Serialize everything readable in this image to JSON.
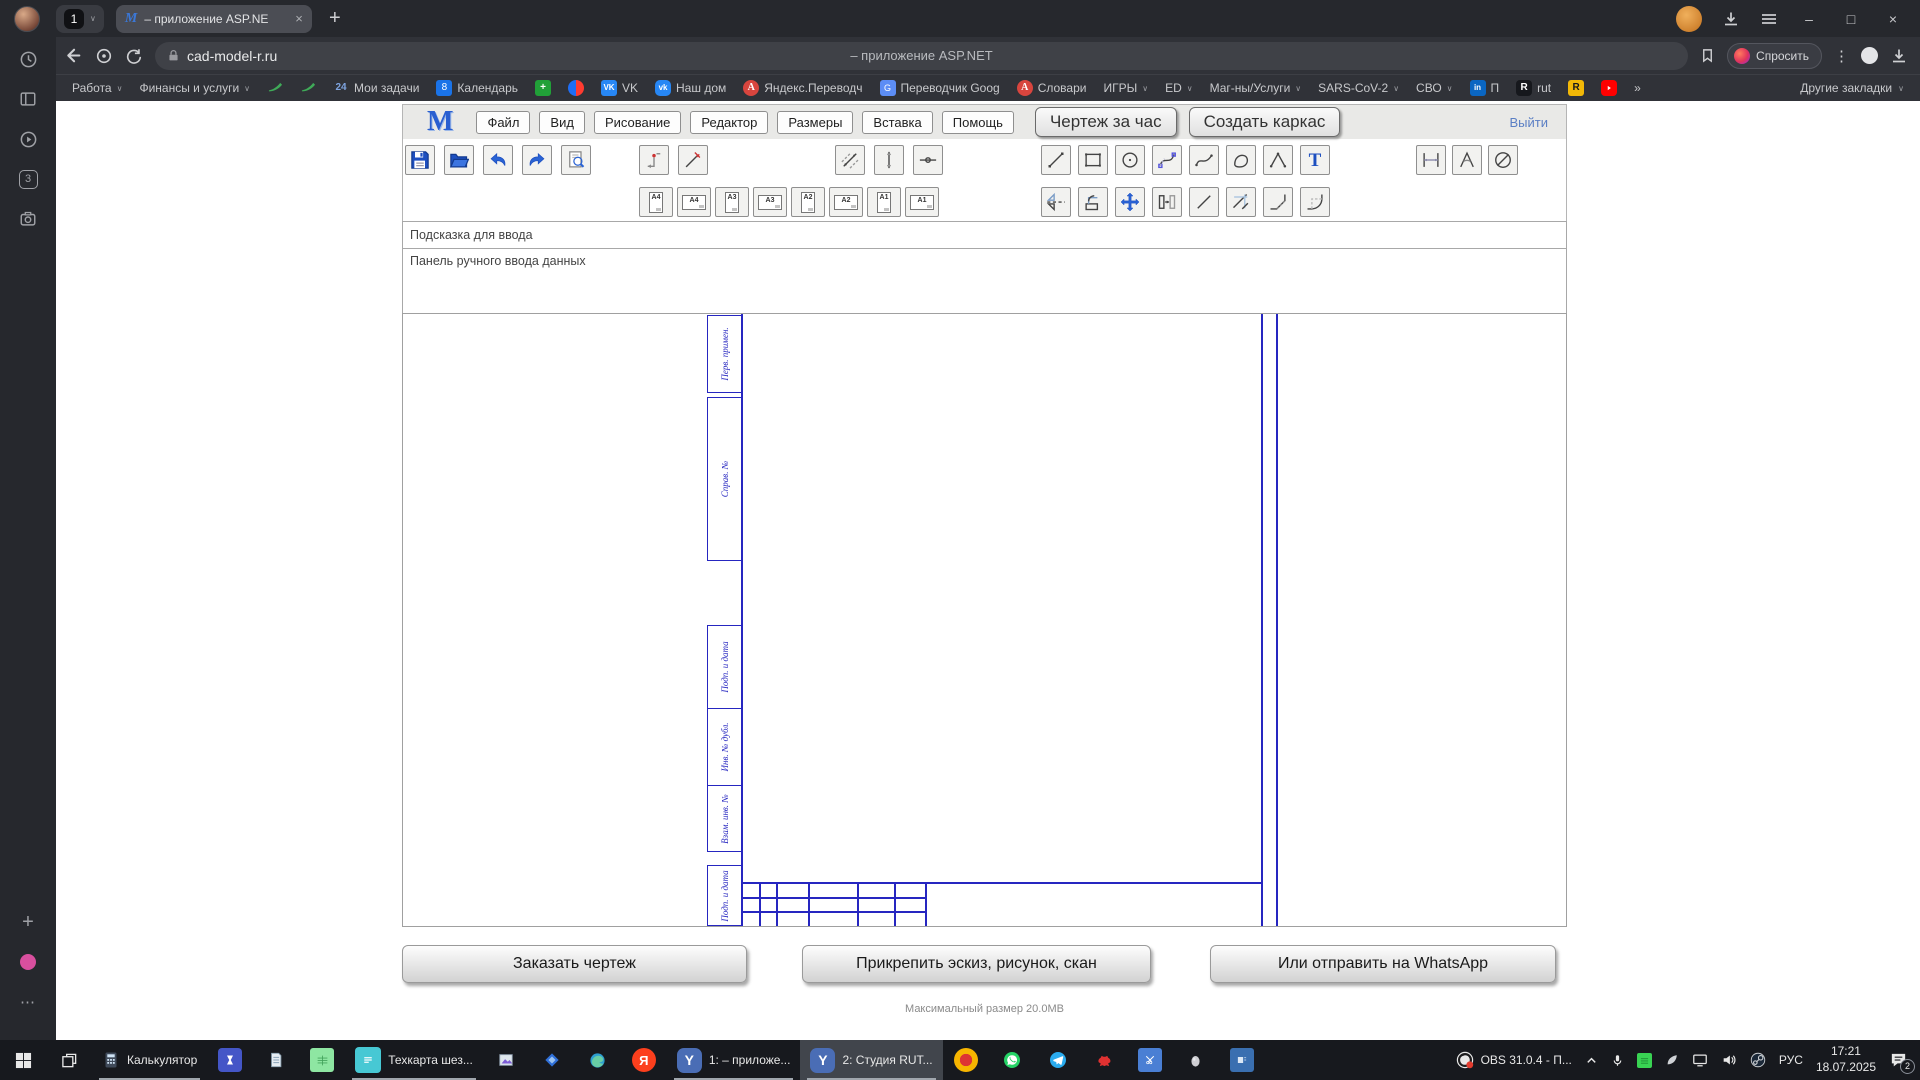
{
  "browser": {
    "window_controls": {
      "minimize": "–",
      "maximize": "□",
      "close": "×"
    },
    "tab_bar": {
      "tab_group_count": "1",
      "active_tab_title": "– приложение ASP.NE",
      "close_glyph": "×",
      "new_tab": "+"
    },
    "address_bar": {
      "url": "cad-model-r.ru",
      "page_title": "– приложение ASP.NET",
      "ask_label": "Спросить"
    },
    "bookmarks": [
      {
        "label": "Работа",
        "chevron": true
      },
      {
        "label": "Финансы и услуги",
        "chevron": true
      },
      {
        "icon": "green-swoosh"
      },
      {
        "icon": "green-swoosh"
      },
      {
        "icon": "b24",
        "label": "Мои задачи"
      },
      {
        "icon": "calendar",
        "label": "Календарь"
      },
      {
        "icon": "green-plus"
      },
      {
        "icon": "mail-circle"
      },
      {
        "icon": "vk",
        "label": "VK"
      },
      {
        "icon": "vk2",
        "label": "Наш дом"
      },
      {
        "icon": "ya",
        "label": "Яндекс.Переводч"
      },
      {
        "icon": "gtr",
        "label": "Переводчик Goog"
      },
      {
        "icon": "ya",
        "label": "Словари"
      },
      {
        "label": "ИГРЫ",
        "chevron": true
      },
      {
        "label": "ED",
        "chevron": true
      },
      {
        "label": "Маг-ны/Услуги",
        "chevron": true
      },
      {
        "label": "SARS-CoV-2",
        "chevron": true
      },
      {
        "label": "СВО",
        "chevron": true
      },
      {
        "icon": "li",
        "label": "П"
      },
      {
        "icon": "rdark",
        "label": "rut"
      },
      {
        "icon": "ryellow"
      },
      {
        "icon": "youtube"
      },
      {
        "label": "»"
      }
    ],
    "other_bookmarks": "Другие закладки"
  },
  "app": {
    "logo": "M",
    "menu": [
      "Файл",
      "Вид",
      "Рисование",
      "Редактор",
      "Размеры",
      "Вставка",
      "Помощь"
    ],
    "action_buttons": [
      "Чертеж за час",
      "Создать каркас"
    ],
    "logout": "Выйти",
    "toolbar": {
      "file_tools": [
        "save",
        "open",
        "undo",
        "redo",
        "preview"
      ],
      "entry_tools": [
        "point-entry",
        "line-entry"
      ],
      "axis_tools": [
        "dim-aligned",
        "axis-vertical",
        "axis-horizontal"
      ],
      "draw_tools": [
        "line",
        "rect",
        "circle",
        "bezier",
        "spline",
        "closed-spline",
        "polyline",
        "text"
      ],
      "dim_tools": [
        "dim-horizontal",
        "dim-angle",
        "dim-diameter"
      ],
      "paper_sizes": [
        {
          "label": "A4",
          "orientation": "portrait"
        },
        {
          "label": "A4",
          "orientation": "landscape"
        },
        {
          "label": "A3",
          "orientation": "portrait"
        },
        {
          "label": "A3",
          "orientation": "landscape"
        },
        {
          "label": "A2",
          "orientation": "portrait"
        },
        {
          "label": "A2",
          "orientation": "landscape"
        },
        {
          "label": "A1",
          "orientation": "portrait"
        },
        {
          "label": "A1",
          "orientation": "landscape"
        }
      ],
      "edit_tools": [
        "mirror",
        "rotate-copy",
        "move",
        "offset",
        "segment",
        "trim",
        "chamfer",
        "fillet"
      ]
    },
    "hint_bar": "Подсказка для ввода",
    "input_panel": "Панель ручного ввода данных",
    "frame_color": "#2626c0",
    "drawing_frame_labels": [
      "Перв. примен.",
      "Справ. №",
      "Подп. и дата",
      "Инв. № дубл.",
      "Взам. инв. №",
      "Подп. и дата"
    ],
    "footer_buttons": [
      "Заказать чертеж",
      "Прикрепить эскиз, рисунок, скан",
      "Или отправить на WhatsApp"
    ],
    "max_size_note": "Максимальный размер 20.0МВ"
  },
  "sidebar": {
    "top_icons": [
      "history",
      "panels",
      "video",
      "tab-counter",
      "screenshot"
    ],
    "tab_counter": "3",
    "bottom_icons": [
      "plus",
      "music-dot",
      "more"
    ]
  },
  "taskbar": {
    "items": [
      {
        "icon": "start"
      },
      {
        "icon": "task-view"
      },
      {
        "icon": "calculator",
        "label": "Калькулятор",
        "open": true
      },
      {
        "icon": "hourglass-app"
      },
      {
        "icon": "notepad"
      },
      {
        "icon": "sheet-green"
      },
      {
        "icon": "doc-teal",
        "label": "Техкарта шез...",
        "open": true
      },
      {
        "icon": "paint"
      },
      {
        "icon": "diamond-blue"
      },
      {
        "icon": "edge"
      },
      {
        "icon": "yandex"
      },
      {
        "icon": "ybrowser",
        "label": "1: – приложе...",
        "open": true
      },
      {
        "icon": "ybrowser",
        "label": "2: Студия RUT...",
        "open": true,
        "active": true
      },
      {
        "icon": "music-orange"
      },
      {
        "icon": "whatsapp"
      },
      {
        "icon": "telegram"
      },
      {
        "icon": "red-creature"
      },
      {
        "icon": "snip-blue"
      },
      {
        "icon": "egg"
      },
      {
        "icon": "cards-blue"
      }
    ],
    "tray": {
      "obs_label": "OBS 31.0.4 - П...",
      "icons": [
        "chevron-up",
        "microphone",
        "green-square",
        "leaf",
        "display",
        "volume",
        "steam"
      ],
      "lang": "РУС",
      "time": "17:21",
      "date": "18.07.2025",
      "notification_badge": "2"
    }
  }
}
